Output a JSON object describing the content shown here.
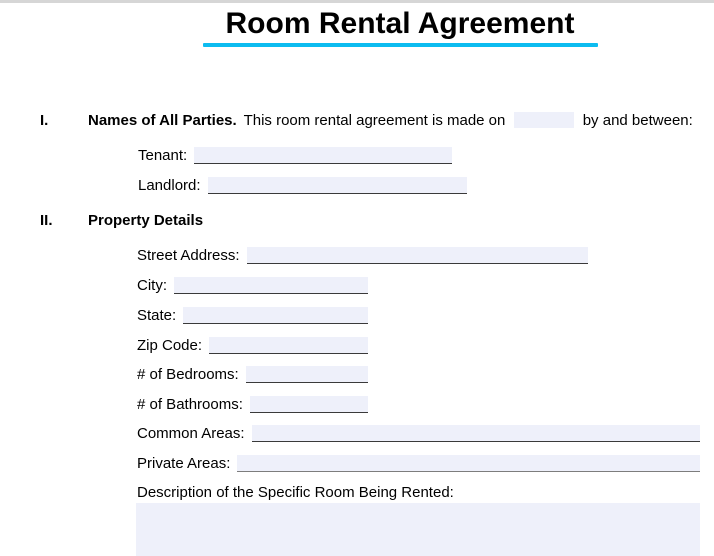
{
  "page": {
    "title": "Room Rental Agreement"
  },
  "colors": {
    "accent_underline": "#0cbcf0",
    "field_fill": "#eef0fa"
  },
  "section1": {
    "numeral": "I.",
    "heading": "Names of All Parties.",
    "intro_before": "This room rental agreement is made on",
    "date_value": "",
    "intro_after": "by and between:",
    "tenant": {
      "label": "Tenant:",
      "value": ""
    },
    "landlord": {
      "label": "Landlord:",
      "value": ""
    }
  },
  "section2": {
    "numeral": "II.",
    "heading": "Property Details",
    "fields": [
      {
        "label": "Street Address:",
        "value": ""
      },
      {
        "label": "City:",
        "value": ""
      },
      {
        "label": "State:",
        "value": ""
      },
      {
        "label": "Zip Code:",
        "value": ""
      },
      {
        "label": "# of Bedrooms:",
        "value": ""
      },
      {
        "label": "# of Bathrooms:",
        "value": ""
      },
      {
        "label": "Common Areas:",
        "value": ""
      },
      {
        "label": "Private Areas:",
        "value": ""
      }
    ],
    "description_label": "Description of the Specific Room Being Rented:",
    "description_value": ""
  }
}
